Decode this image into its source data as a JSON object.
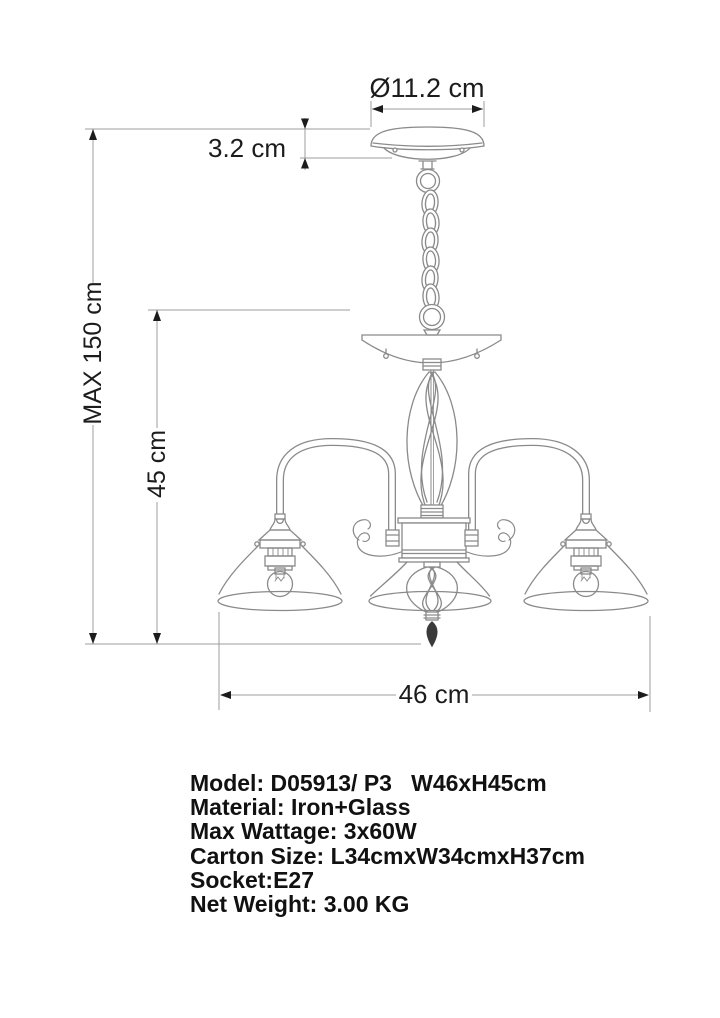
{
  "diagram": {
    "title": "chandelier-dimension-drawing",
    "dimensions": {
      "canopy_diameter": "Ø11.2 cm",
      "canopy_height": "3.2 cm",
      "max_height": "MAX 150 cm",
      "fixture_height": "45 cm",
      "fixture_width": "46 cm"
    },
    "specs": [
      "Model: D05913/ P3   W46xH45cm",
      "Material: Iron+Glass",
      "Max Wattage: 3x60W",
      "Carton Size: L34cmxW34cmxH37cm",
      "Socket:E27",
      "Net Weight: 3.00 KG"
    ],
    "colors": {
      "drawing_line": "#8a8a8a",
      "dimension_line": "#9c9c9c",
      "arrow_and_text": "#1c1c1c",
      "background": "#ffffff"
    }
  }
}
